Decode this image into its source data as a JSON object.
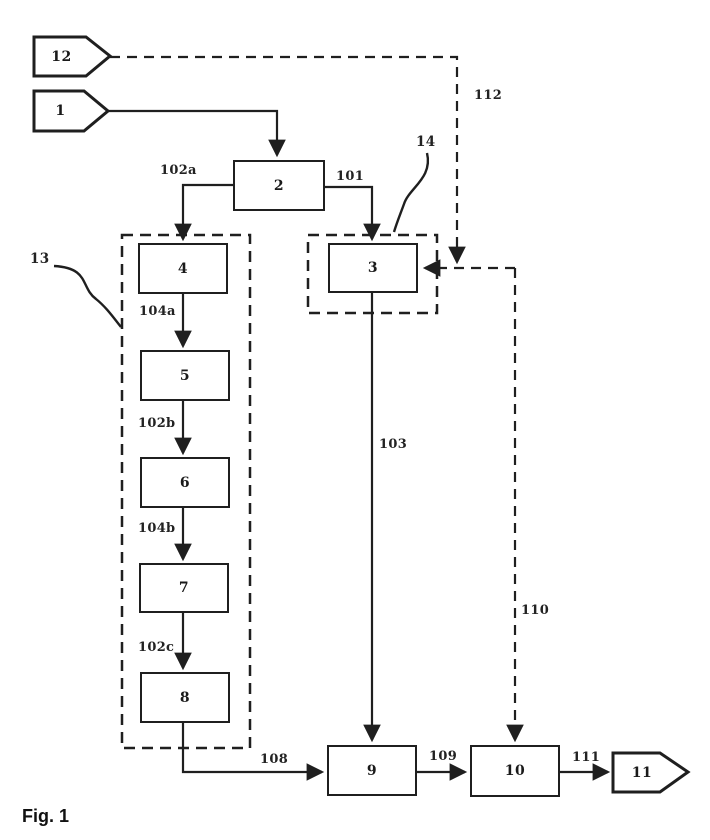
{
  "caption": "Fig. 1",
  "nodes": {
    "tag12": "12",
    "tag1": "1",
    "box2": "2",
    "box3": "3",
    "box4": "4",
    "box5": "5",
    "box6": "6",
    "box7": "7",
    "box8": "8",
    "box9": "9",
    "box10": "10",
    "tag11": "11"
  },
  "groups": {
    "g13": "13",
    "g14": "14"
  },
  "edge_labels": {
    "e101": "101",
    "e102a": "102a",
    "e102b": "102b",
    "e102c": "102c",
    "e103": "103",
    "e104a": "104a",
    "e104b": "104b",
    "e108": "108",
    "e109": "109",
    "e110": "110",
    "e111": "111",
    "e112": "112"
  },
  "colors": {
    "stroke": "#1f1f1f",
    "background": "#ffffff"
  }
}
